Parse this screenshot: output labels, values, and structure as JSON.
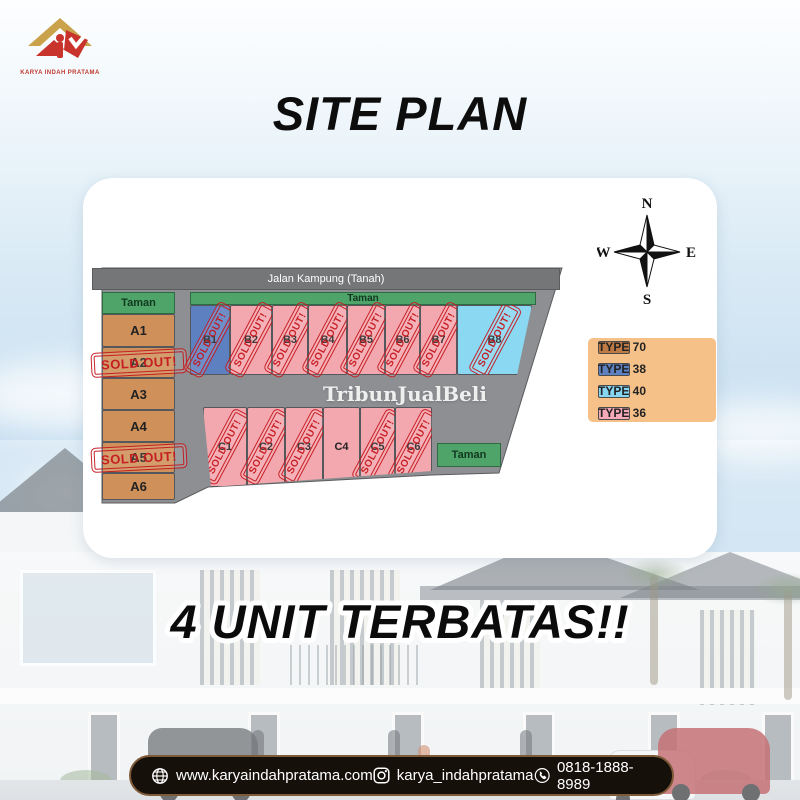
{
  "logo": {
    "caption": "KARYA INDAH PRATAMA"
  },
  "title": "SITE PLAN",
  "banner": "4 UNIT TERBATAS!!",
  "siteplan": {
    "road_label": "Jalan Kampung (Tanah)",
    "park_label": "Taman",
    "watermark": "TribunJualBeli",
    "sold_stamp_label": "SOLD OUT!",
    "compass": {
      "n": "N",
      "e": "E",
      "s": "S",
      "w": "W"
    },
    "legend": [
      {
        "label": "TYPE 70",
        "color": "#bd7a45"
      },
      {
        "label": "TYPE 38",
        "color": "#5d80c1"
      },
      {
        "label": "TYPE 40",
        "color": "#86d6f2"
      },
      {
        "label": "TYPE 36",
        "color": "#f6a9b8"
      }
    ],
    "lot_fill_colors": {
      "70": "#cf9059",
      "38": "#5d80c1",
      "40": "#8ad8f2",
      "36": "#f3a7ae"
    },
    "lots_a": [
      {
        "label": "A1",
        "type": "70",
        "sold": false
      },
      {
        "label": "A2",
        "type": "70",
        "sold": true
      },
      {
        "label": "A3",
        "type": "70",
        "sold": false
      },
      {
        "label": "A4",
        "type": "70",
        "sold": false
      },
      {
        "label": "A5",
        "type": "70",
        "sold": true
      },
      {
        "label": "A6",
        "type": "70",
        "sold": false
      }
    ],
    "lots_b": [
      {
        "label": "B1",
        "type": "38",
        "sold": true
      },
      {
        "label": "B2",
        "type": "36",
        "sold": true
      },
      {
        "label": "B3",
        "type": "36",
        "sold": true
      },
      {
        "label": "B4",
        "type": "36",
        "sold": true
      },
      {
        "label": "B5",
        "type": "36",
        "sold": true
      },
      {
        "label": "B6",
        "type": "36",
        "sold": true
      },
      {
        "label": "B7",
        "type": "36",
        "sold": true
      },
      {
        "label": "B8",
        "type": "40",
        "sold": true
      }
    ],
    "lots_c": [
      {
        "label": "C1",
        "type": "36",
        "sold": true
      },
      {
        "label": "C2",
        "type": "36",
        "sold": true
      },
      {
        "label": "C3",
        "type": "36",
        "sold": true
      },
      {
        "label": "C4",
        "type": "36",
        "sold": false
      },
      {
        "label": "C5",
        "type": "36",
        "sold": true
      },
      {
        "label": "C6",
        "type": "36",
        "sold": true
      }
    ],
    "colors": {
      "stamp_red": "#c5191f",
      "park_green": "#4fa469",
      "road_gray": "#747678",
      "parcel_gray": "#8d8f92"
    }
  },
  "footer": {
    "website": "www.karyaindahpratama.com",
    "instagram": "karya_indahpratama",
    "phone": "0818-1888-8989"
  }
}
